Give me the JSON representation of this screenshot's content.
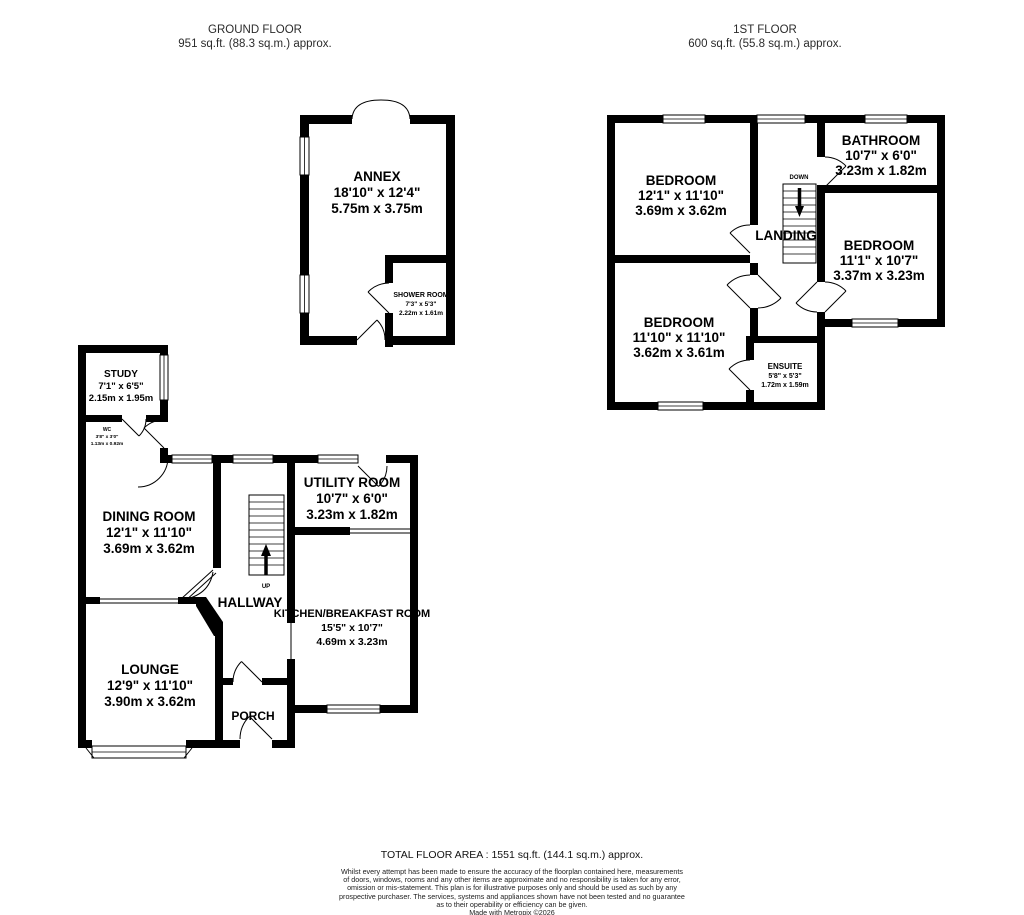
{
  "headers": {
    "ground": {
      "title": "GROUND FLOOR",
      "area": "951 sq.ft. (88.3 sq.m.) approx."
    },
    "first": {
      "title": "1ST FLOOR",
      "area": "600 sq.ft. (55.8 sq.m.) approx."
    }
  },
  "rooms": {
    "annex": {
      "name": "ANNEX",
      "imperial": "18'10\" x 12'4\"",
      "metric": "5.75m x 3.75m"
    },
    "shower_room": {
      "name": "SHOWER ROOM",
      "imperial": "7'3\" x 5'3\"",
      "metric": "2.22m x 1.61m"
    },
    "study": {
      "name": "STUDY",
      "imperial": "7'1\" x 6'5\"",
      "metric": "2.15m x 1.95m"
    },
    "wc": {
      "name": "WC",
      "imperial": "3'8\" x 3'0\"",
      "metric": "1.13m x 0.92m"
    },
    "dining_room": {
      "name": "DINING ROOM",
      "imperial": "12'1\" x 11'10\"",
      "metric": "3.69m x 3.62m"
    },
    "utility_room": {
      "name": "UTILITY ROOM",
      "imperial": "10'7\" x 6'0\"",
      "metric": "3.23m x 1.82m"
    },
    "hallway": {
      "name": "HALLWAY"
    },
    "kitchen_breakfast": {
      "name": "KITCHEN/BREAKFAST ROOM",
      "imperial": "15'5\" x 10'7\"",
      "metric": "4.69m x 3.23m"
    },
    "lounge": {
      "name": "LOUNGE",
      "imperial": "12'9\" x 11'10\"",
      "metric": "3.90m x 3.62m"
    },
    "porch": {
      "name": "PORCH"
    },
    "bedroom_1": {
      "name": "BEDROOM",
      "imperial": "12'1\" x 11'10\"",
      "metric": "3.69m x 3.62m"
    },
    "bathroom": {
      "name": "BATHROOM",
      "imperial": "10'7\" x 6'0\"",
      "metric": "3.23m x 1.82m"
    },
    "landing": {
      "name": "LANDING"
    },
    "bedroom_2": {
      "name": "BEDROOM",
      "imperial": "11'1\" x 10'7\"",
      "metric": "3.37m x 3.23m"
    },
    "bedroom_3": {
      "name": "BEDROOM",
      "imperial": "11'10\" x 11'10\"",
      "metric": "3.62m x 3.61m"
    },
    "ensuite": {
      "name": "ENSUITE",
      "imperial": "5'8\" x 5'3\"",
      "metric": "1.72m x 1.59m"
    }
  },
  "stairs": {
    "up": "UP",
    "down": "DOWN"
  },
  "footer": {
    "total_area": "TOTAL FLOOR AREA : 1551 sq.ft. (144.1 sq.m.) approx.",
    "disclaimer_lines": [
      "Whilst every attempt has been made to ensure the accuracy of the floorplan contained here, measurements",
      "of doors, windows, rooms and any other items are approximate and no responsibility is taken for any error,",
      "omission or mis-statement. This plan is for illustrative purposes only and should be used as such by any",
      "prospective purchaser. The services, systems and appliances shown have not been tested and no guarantee",
      "as to their operability or efficiency can be given."
    ],
    "credit": "Made with Metropix ©2026"
  },
  "colors": {
    "wall": "#000000",
    "background": "#ffffff",
    "text": "#1a1a1a"
  }
}
